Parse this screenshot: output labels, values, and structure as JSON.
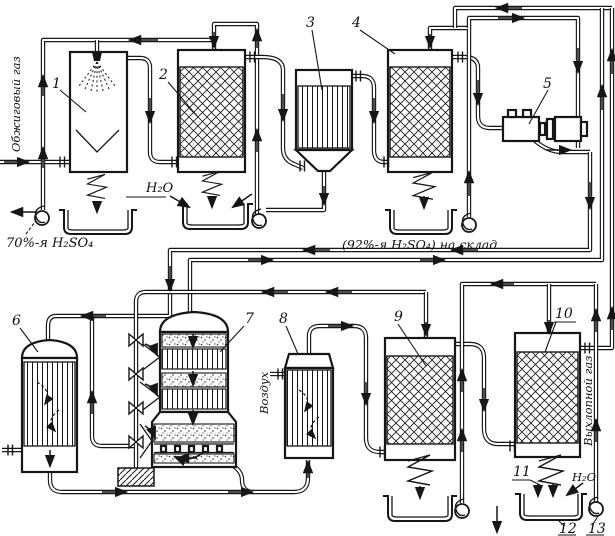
{
  "figure": {
    "colors": {
      "ink": "#161616",
      "paper": "#ffffff"
    },
    "labels": {
      "roasting_gas": "Обжиговый газ",
      "acid_70": "70%-я H₂SO₄",
      "water_top": "H₂O",
      "acid_92_storage": "(92%-я H₂SO₄) на склад",
      "air": "Воздух",
      "exhaust_gas": "Выхлопной газ",
      "water_bottom": "H₂O"
    },
    "equipment_numbers": {
      "n1": "1",
      "n2": "2",
      "n3": "3",
      "n4": "4",
      "n5": "5",
      "n6": "6",
      "n7": "7",
      "n8": "8",
      "n9": "9",
      "n10": "10",
      "n11": "11",
      "n12": "12",
      "n13": "13"
    }
  }
}
